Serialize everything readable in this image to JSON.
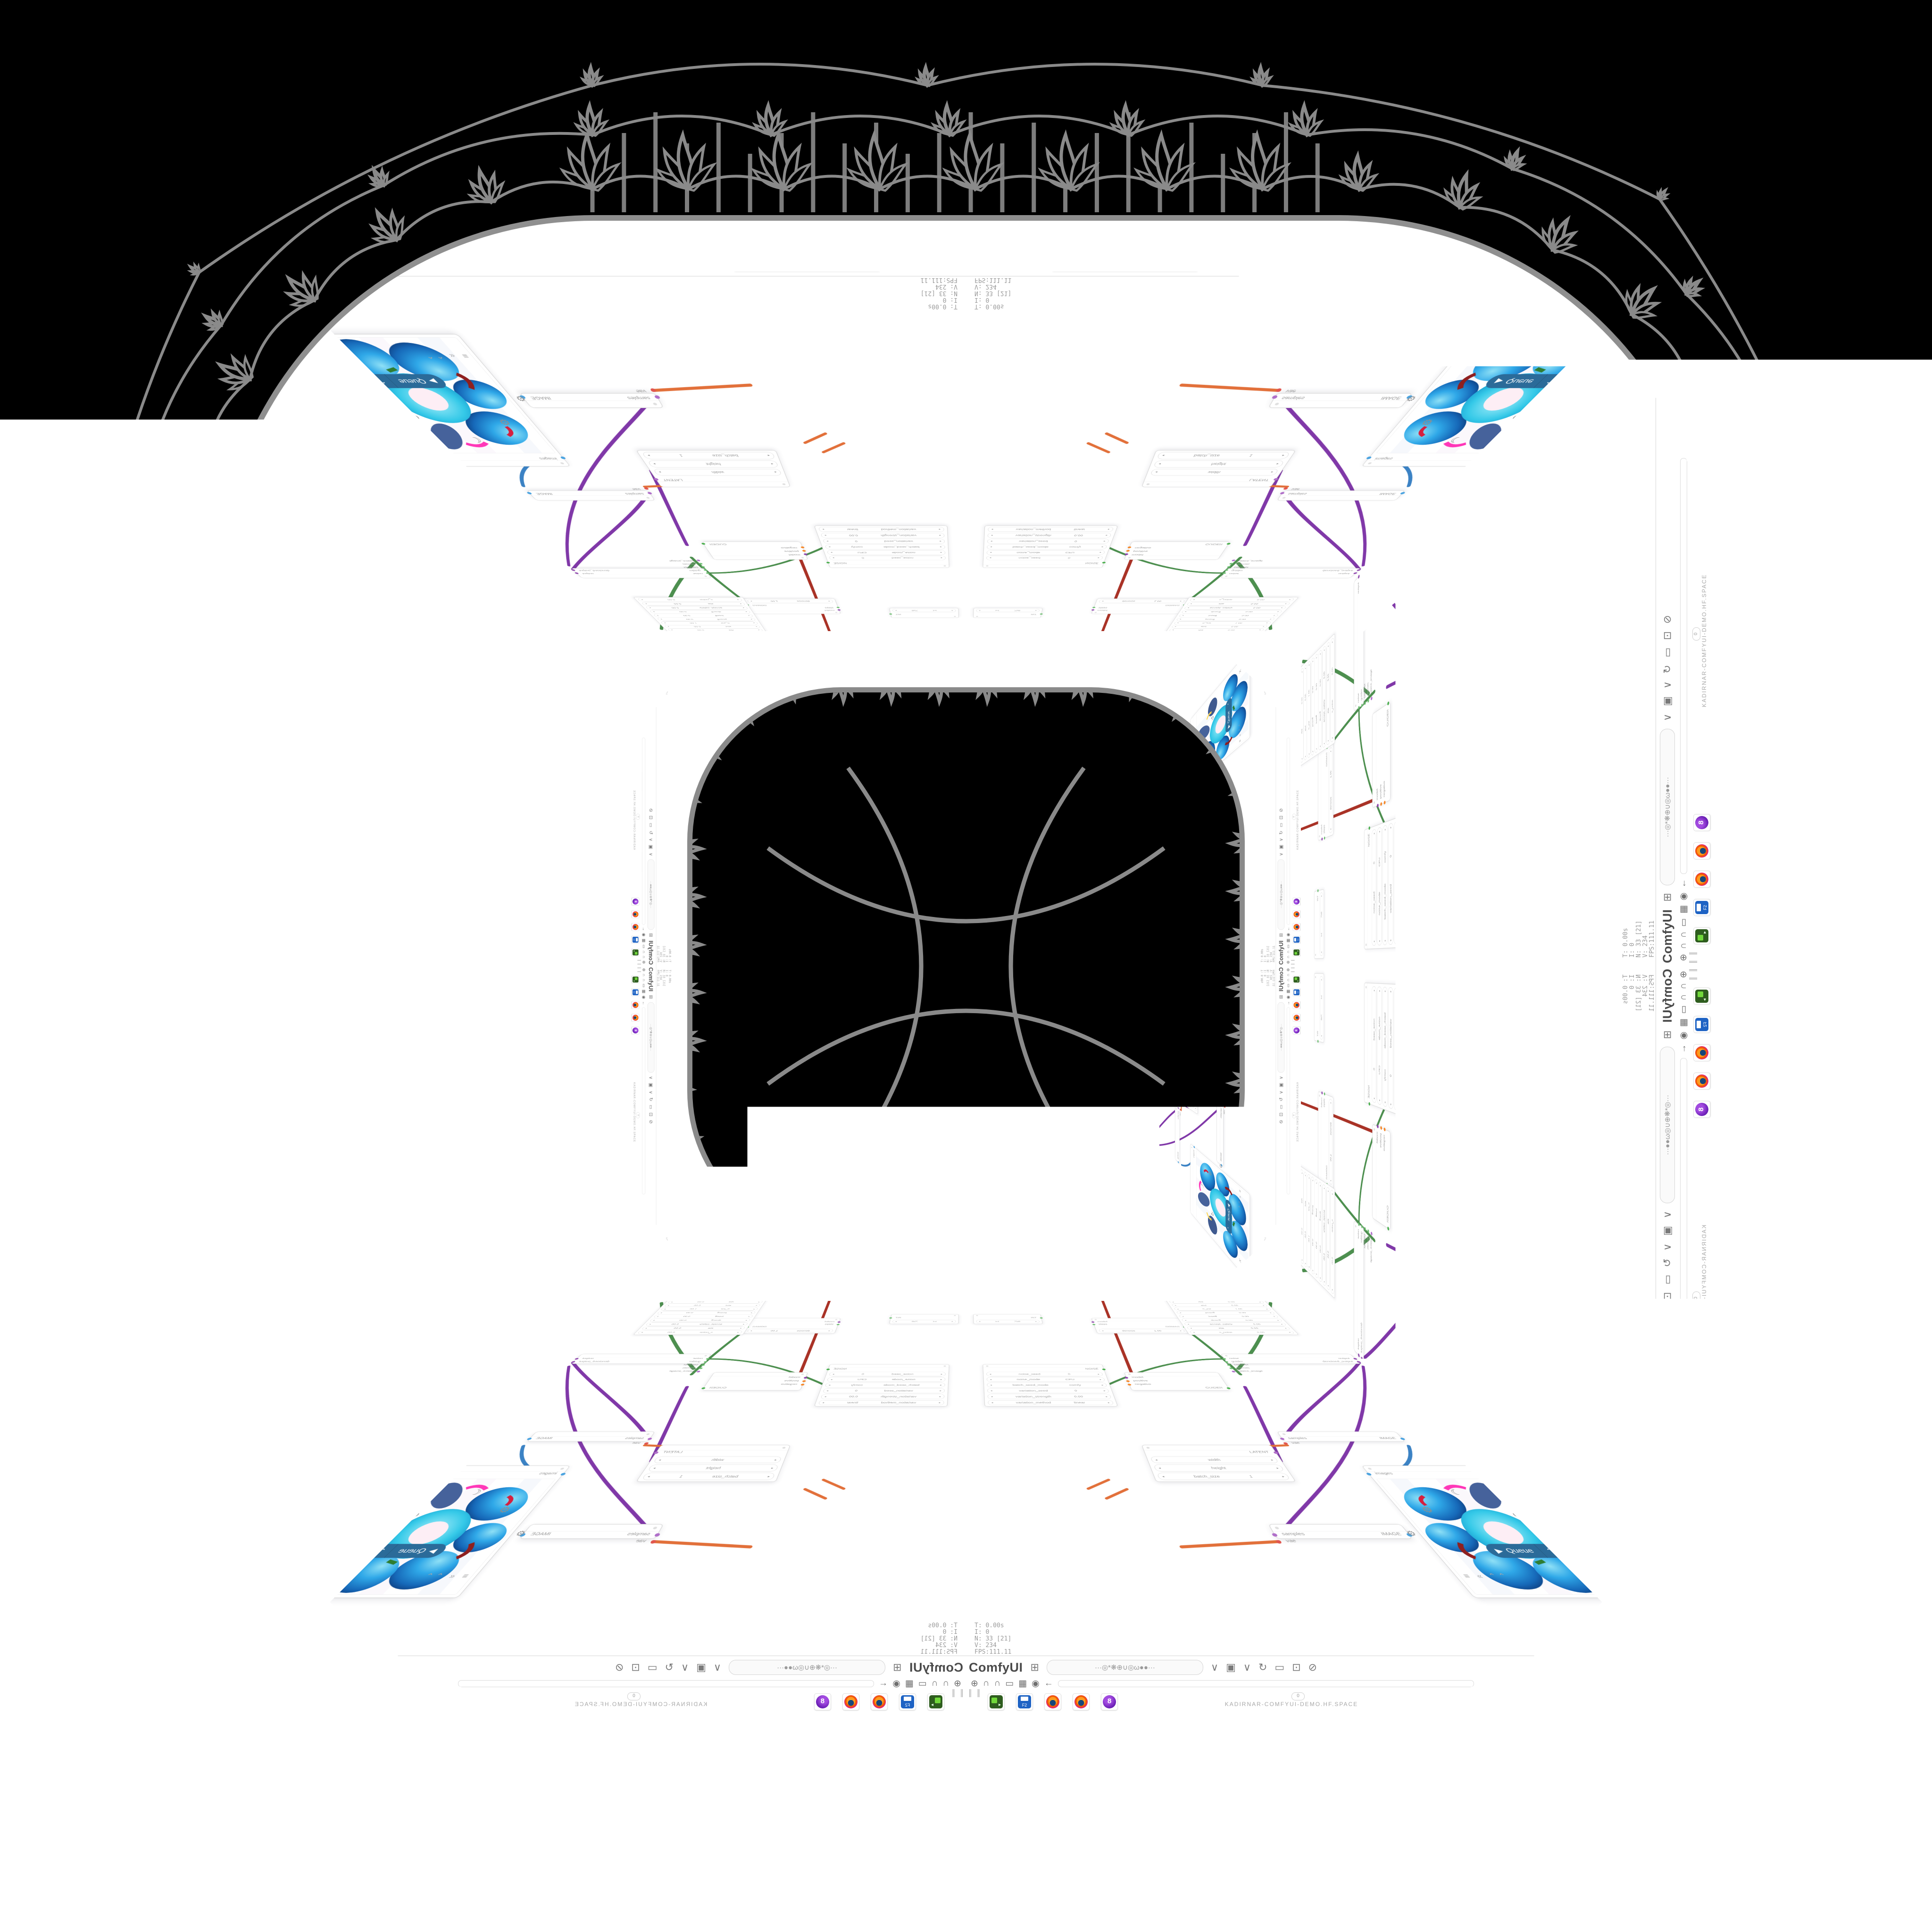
{
  "app": {
    "name": "ComfyUI",
    "url_caption": "KADIRNAR-COMFYUI-DEMO.HF.SPACE",
    "url_blurred": "···◎*❋⊕∪◎ω●●···",
    "page_zero": "0",
    "edge_ticks": "0.00  0.00  0.52  0.19  23  360  112  124  1.5  3.0  34  35"
  },
  "stats": {
    "text": "T: 0.00s\nI: 0\nN: 33 [21]\nV: 234\nFPS:111.11"
  },
  "queue": {
    "label": "Queue",
    "play": "▶",
    "chev": "⌃"
  },
  "toolbar": {
    "app_label": "ComfyUI",
    "share_icon": "⊞",
    "chevron": "∨",
    "save_icon": "▣",
    "reload_icon": "↻",
    "slash_icon": "⊘",
    "clipboard_icon": "▭",
    "ext_icon": "⊡",
    "close_icon": "✕"
  },
  "workflow_bar": {
    "icons": [
      "⊕",
      "∩",
      "∩",
      "▭",
      "▦",
      "◉",
      "←"
    ],
    "pipes": "║ ║"
  },
  "corner_icons": {
    "gear": "⚙",
    "moon": "☾",
    "undo": "↺",
    "redo": "↻",
    "menu": "≡ « ⌃⌃",
    "trash": "▦"
  },
  "nodes": {
    "ckpt": {
      "widgets": [
        {
          "l": "ckpt_name",
          "v": "RealVisXL_V4.0_Lightning.safetensors"
        }
      ],
      "outputs": [
        {
          "n": "MODEL",
          "c": "#8e44ad"
        },
        {
          "n": "CLIP",
          "c": "#f0a431"
        },
        {
          "n": "VAE",
          "c": "#e1564f"
        }
      ]
    },
    "string": {
      "outputs": [
        {
          "n": "STRING",
          "c": "#6fbf73"
        }
      ],
      "widgets": [
        {
          "l": "text",
          "v": ""
        }
      ]
    },
    "clip": {
      "inputs": [
        {
          "n": "clip",
          "c": "#f0a431"
        }
      ],
      "outputs": [
        {
          "n": "CONDITIONING",
          "c": "#f5882a"
        }
      ],
      "widgets": [
        {
          "l": "text",
          "v": ""
        }
      ]
    },
    "floatb": {
      "outputs": [
        {
          "n": "FLOAT",
          "c": "#9ccc65"
        }
      ],
      "widgets": [
        {
          "l": "Value_B",
          "v": "1.00"
        }
      ]
    },
    "int8": {
      "outputs": [
        {
          "n": "INT",
          "c": "#6fbf73"
        }
      ],
      "widgets": [
        {
          "l": "Value",
          "v": "8"
        }
      ]
    },
    "int256": {
      "outputs": [
        {
          "n": "INT",
          "c": "#6fbf73"
        }
      ],
      "widgets": [
        {
          "l": "int",
          "v": "256"
        }
      ]
    },
    "sched": {
      "inputs": [
        {
          "n": "model",
          "c": "#8e44ad"
        },
        {
          "n": "steps",
          "c": "#6fbf73"
        }
      ],
      "outputs": [
        {
          "n": "SIGMAS",
          "c": "#4caf50"
        }
      ],
      "widgets": [
        {
          "l": "denoise",
          "v": "1.00"
        }
      ]
    },
    "dpm": {
      "outputs": [
        {
          "n": "SAMPLER",
          "c": "#4caf50"
        }
      ],
      "widgets": [
        {
          "l": "order",
          "v": "3"
        },
        {
          "l": "rtol",
          "v": "0.00"
        },
        {
          "l": "atol",
          "v": "0.00"
        },
        {
          "l": "h_init",
          "v": "1.00"
        },
        {
          "l": "pcoeff",
          "v": "0.00"
        },
        {
          "l": "icoeff",
          "v": "0.00"
        },
        {
          "l": "dcoeff",
          "v": "0.00"
        },
        {
          "l": "accept_safety",
          "v": "0.00"
        },
        {
          "l": "eta",
          "v": "0.00"
        },
        {
          "l": "s_noise",
          "v": "0.00"
        }
      ]
    },
    "noise": {
      "outputs": [
        {
          "n": "NOISE",
          "c": "#4caf50"
        }
      ],
      "widgets": [
        {
          "l": "noise_seed",
          "v": "0"
        },
        {
          "l": "noise_mode",
          "v": "CPU"
        },
        {
          "l": "batch_seed_mode",
          "v": "comfy"
        },
        {
          "l": "variation_seed",
          "v": "0"
        },
        {
          "l": "variation_strength",
          "v": "0.00"
        },
        {
          "l": "variation_method",
          "v": "linear"
        }
      ]
    },
    "guider": {
      "inputs": [
        {
          "n": "model",
          "c": "#8e44ad"
        },
        {
          "n": "positive",
          "c": "#f5882a"
        },
        {
          "n": "negative",
          "c": "#f5882a"
        }
      ],
      "outputs": [
        {
          "n": "GUIDER",
          "c": "#4caf50"
        }
      ]
    },
    "sca": {
      "inputs": [
        {
          "n": "noise",
          "c": "#6fbf73"
        },
        {
          "n": "guider",
          "c": "#6fbf73"
        },
        {
          "n": "sampler",
          "c": "#6fbf73"
        },
        {
          "n": "sigmas",
          "c": "#6fbf73"
        },
        {
          "n": "latent_image",
          "c": "#b06fc9"
        }
      ],
      "outputs": [
        {
          "n": "output",
          "c": "#8e44ad"
        },
        {
          "n": "denoised_output",
          "c": "#8e44ad"
        }
      ]
    },
    "latent": {
      "outputs": [
        {
          "n": "LATENT",
          "c": "#b06fc9"
        }
      ],
      "widgets": [
        {
          "l": "width",
          "v": ""
        },
        {
          "l": "height",
          "v": ""
        },
        {
          "l": "batch_size",
          "v": "1"
        }
      ]
    },
    "vae": {
      "inputs": [
        {
          "n": "samples",
          "c": "#b06fc9"
        },
        {
          "n": "vae",
          "c": "#e1564f"
        }
      ],
      "outputs": [
        {
          "n": "IMAGE",
          "c": "#4aa3e0"
        }
      ]
    },
    "preview": {
      "inputs": [
        {
          "n": "images",
          "c": "#4aa3e0"
        }
      ]
    }
  },
  "colors": {
    "queue_blue": "#2b6b99",
    "lace_gray": "#8a8a8a",
    "rim_gray": "#8f8f8f",
    "wire_green": "#4d8f4f",
    "wire_purple": "#8038a8",
    "wire_orange": "#e2703a",
    "wire_red": "#a93226",
    "wire_blue": "#3b82c4"
  }
}
